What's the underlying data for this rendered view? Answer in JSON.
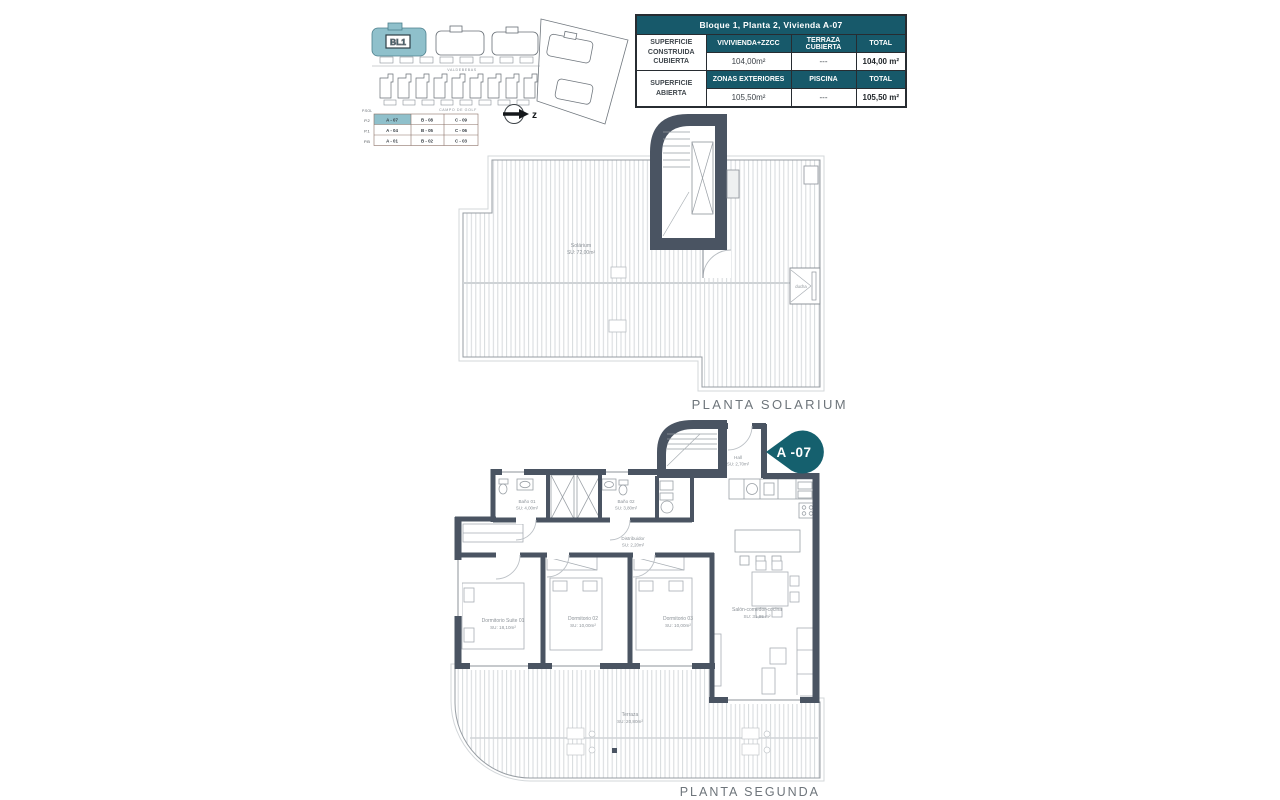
{
  "colors": {
    "accent_teal": "#17596a",
    "highlight_teal": "#8fc0cb",
    "wall_slate": "#4a5462"
  },
  "site_plan": {
    "block_label": "BL1",
    "street_label_1": "VALDEBEBAS",
    "street_label_2": "CAMPO DE GOLF",
    "north_label": "z",
    "legend": {
      "title": "P.SOL",
      "rows": [
        {
          "floor": "P.2",
          "cells": [
            "A - 07",
            "B - 08",
            "C - 09"
          ]
        },
        {
          "floor": "P.1",
          "cells": [
            "A - 04",
            "B - 05",
            "C - 06"
          ]
        },
        {
          "floor": "P.B",
          "cells": [
            "A - 01",
            "B - 02",
            "C - 03"
          ]
        }
      ]
    }
  },
  "summary_table": {
    "title": "Bloque 1, Planta 2, Vivienda A-07",
    "groups": [
      {
        "label": "SUPERFICIE CONSTRUIDA CUBIERTA",
        "headers": [
          "VIVIVIENDA+ZZCC",
          "TERRAZA CUBIERTA",
          "TOTAL"
        ],
        "values": [
          "104,00m²",
          "---",
          "104,00 m²"
        ]
      },
      {
        "label": "SUPERFICIE ABIERTA",
        "headers": [
          "ZONAS EXTERIORES",
          "PISCINA",
          "TOTAL"
        ],
        "values": [
          "105,50m²",
          "---",
          "105,50 m²"
        ]
      }
    ]
  },
  "solarium_plan": {
    "title": "PLANTA SOLARIUM",
    "room_label": "Solárium",
    "room_area": "SU: 72,00m²",
    "shower_label": "ducha"
  },
  "segunda_plan": {
    "title": "PLANTA SEGUNDA",
    "badge": "A -07",
    "rooms": {
      "bano01": {
        "name": "Baño 01",
        "area": "SU: 4,00m²"
      },
      "bano02": {
        "name": "Baño 02",
        "area": "SU: 3,80m²"
      },
      "hall": {
        "name": "Hall",
        "area": "SU: 2,70m²"
      },
      "distribuidor": {
        "name": "Distribuidor",
        "area": "SU: 2,20m²"
      },
      "suite": {
        "name": "Dormitorio Suite 01",
        "area": "SU: 18,10m²"
      },
      "dorm02": {
        "name": "Dormitorio 02",
        "area": "SU: 10,00m²"
      },
      "dorm03": {
        "name": "Dormitorio 03",
        "area": "SU: 10,00m²"
      },
      "salon": {
        "name": "Salón-comedor-cocina",
        "area": "SU: 31,95 m²"
      },
      "terraza": {
        "name": "Terraza",
        "area": "SU: 20,80m²"
      }
    }
  }
}
